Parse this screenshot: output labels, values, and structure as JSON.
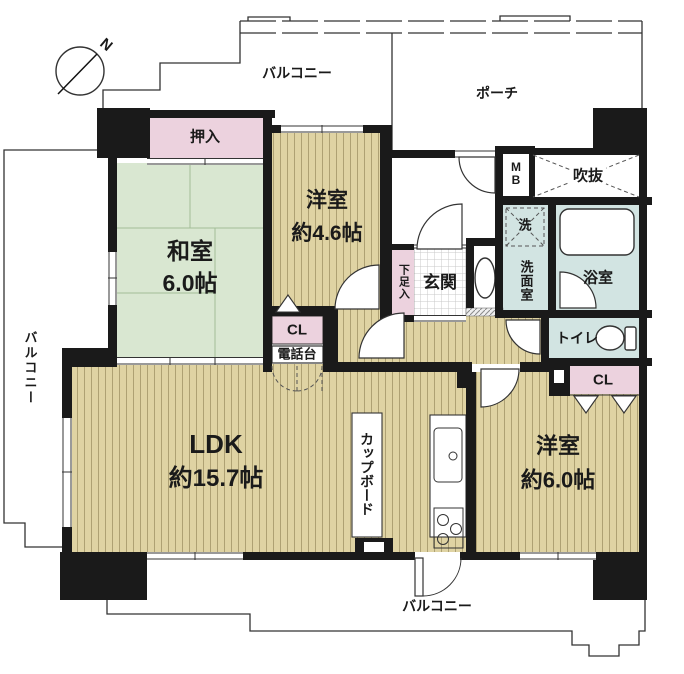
{
  "colors": {
    "wall": "#1a1a1a",
    "tatami": "#d9e7d1",
    "tatami-line": "#a3bd98",
    "wood": "#dfd3a3",
    "wood-stripe": "#9d9063",
    "pink": "#ecd2de",
    "blue": "#d2e4e2",
    "outline": "#333333",
    "text": "#1a1a1a",
    "tile-line": "#c8c8c8"
  },
  "compass": {
    "north": "N"
  },
  "outdoor": {
    "balcony_top": "バルコニー",
    "balcony_left": "バルコニー",
    "balcony_bottom": "バルコニー",
    "porch": "ポーチ"
  },
  "rooms": {
    "washitsu": {
      "name": "和室",
      "size": "6.0帖"
    },
    "yoshitsu46": {
      "name": "洋室",
      "size": "約4.6帖"
    },
    "yoshitsu60": {
      "name": "洋室",
      "size": "約6.0帖"
    },
    "ldk": {
      "name": "LDK",
      "size": "約15.7帖"
    },
    "genkan": {
      "name": "玄関"
    },
    "bath": {
      "name": "浴室"
    },
    "toilet": {
      "name": "トイレ"
    },
    "senmen": {
      "name": "洗面室"
    },
    "fukinuke": {
      "name": "吹抜"
    }
  },
  "storage": {
    "oshiire": "押入",
    "closet_a": "CL",
    "closet_b": "CL",
    "shoe_box": "下足入",
    "cupboard": "カップボード",
    "phone_stand": "電話台",
    "meter_box_m": "M",
    "meter_box_b": "B",
    "washer": "洗"
  }
}
